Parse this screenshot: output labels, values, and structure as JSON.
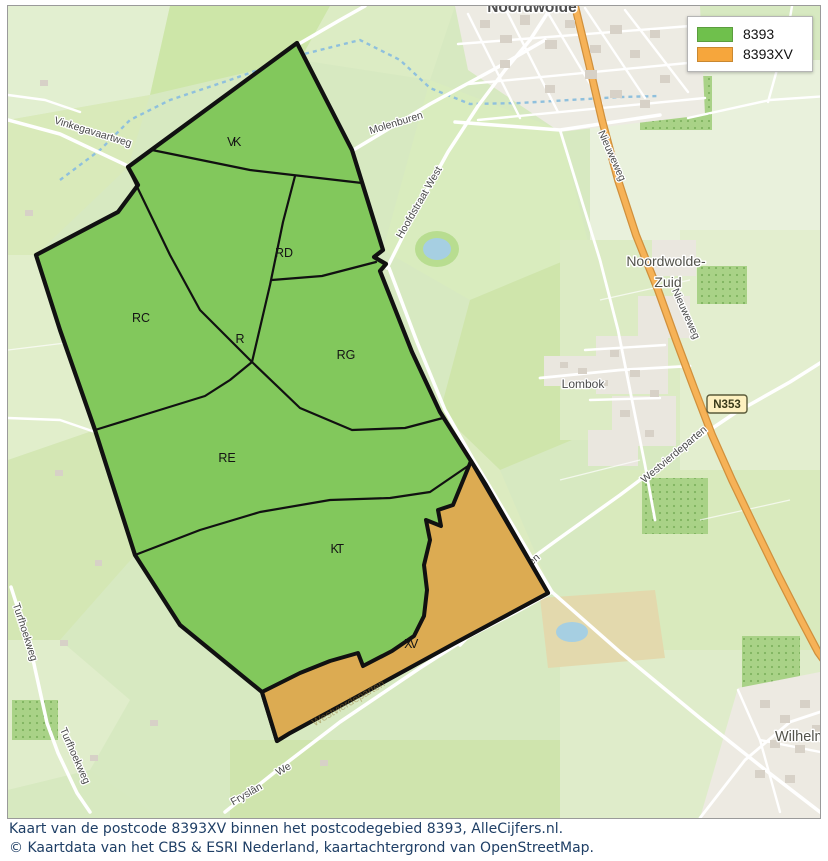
{
  "legend": {
    "items": [
      {
        "label": "8393",
        "color": "#6fc04c"
      },
      {
        "label": "8393XV",
        "color": "#f6a63c"
      }
    ]
  },
  "regions": [
    {
      "code": "VK"
    },
    {
      "code": "RD"
    },
    {
      "code": "RC"
    },
    {
      "code": "R"
    },
    {
      "code": "RG"
    },
    {
      "code": "RE"
    },
    {
      "code": "KT"
    },
    {
      "code": "XV"
    }
  ],
  "roads": {
    "vinkegavaartweg": "Vinkegavaartweg",
    "molenburen": "Molenburen",
    "hoofdstraat_west": "Hoofdstraat West",
    "nieuweweg_north": "Nieuweweg",
    "nieuweweg_south": "Nieuweweg",
    "n353": "N353",
    "westvierdeparten": "Westvierdeparten",
    "westvierdeparten_fragment": "en",
    "westvierdeparten_faint": "Westvierdeparten",
    "we_fragment": "We",
    "turfhoekweg_north": "Turfhoekweg",
    "turfhoekweg_south": "Turfhoekweg"
  },
  "places": {
    "noordwolde": "Noordwolde",
    "noordwolde_zuid_1": "Noordwolde-",
    "noordwolde_zuid_2": "Zuid",
    "lombok": "Lombok",
    "fryslan": "Fryslân",
    "wilhelminaoord": "Wilhelmi"
  },
  "caption": {
    "line1": "Kaart van de postcode 8393XV binnen het postcodegebied 8393, AlleCijfers.nl.",
    "line2": "© Kaartdata van het CBS & ESRI Nederland, kaartachtergrond van OpenStreetMap."
  },
  "colors": {
    "zone_green": "#82c85c",
    "zone_orange": "#dcab52",
    "legend_green": "#6fc04c",
    "legend_orange": "#f6a63c",
    "boundary": "#111111",
    "caption_text": "#1f3f66"
  }
}
